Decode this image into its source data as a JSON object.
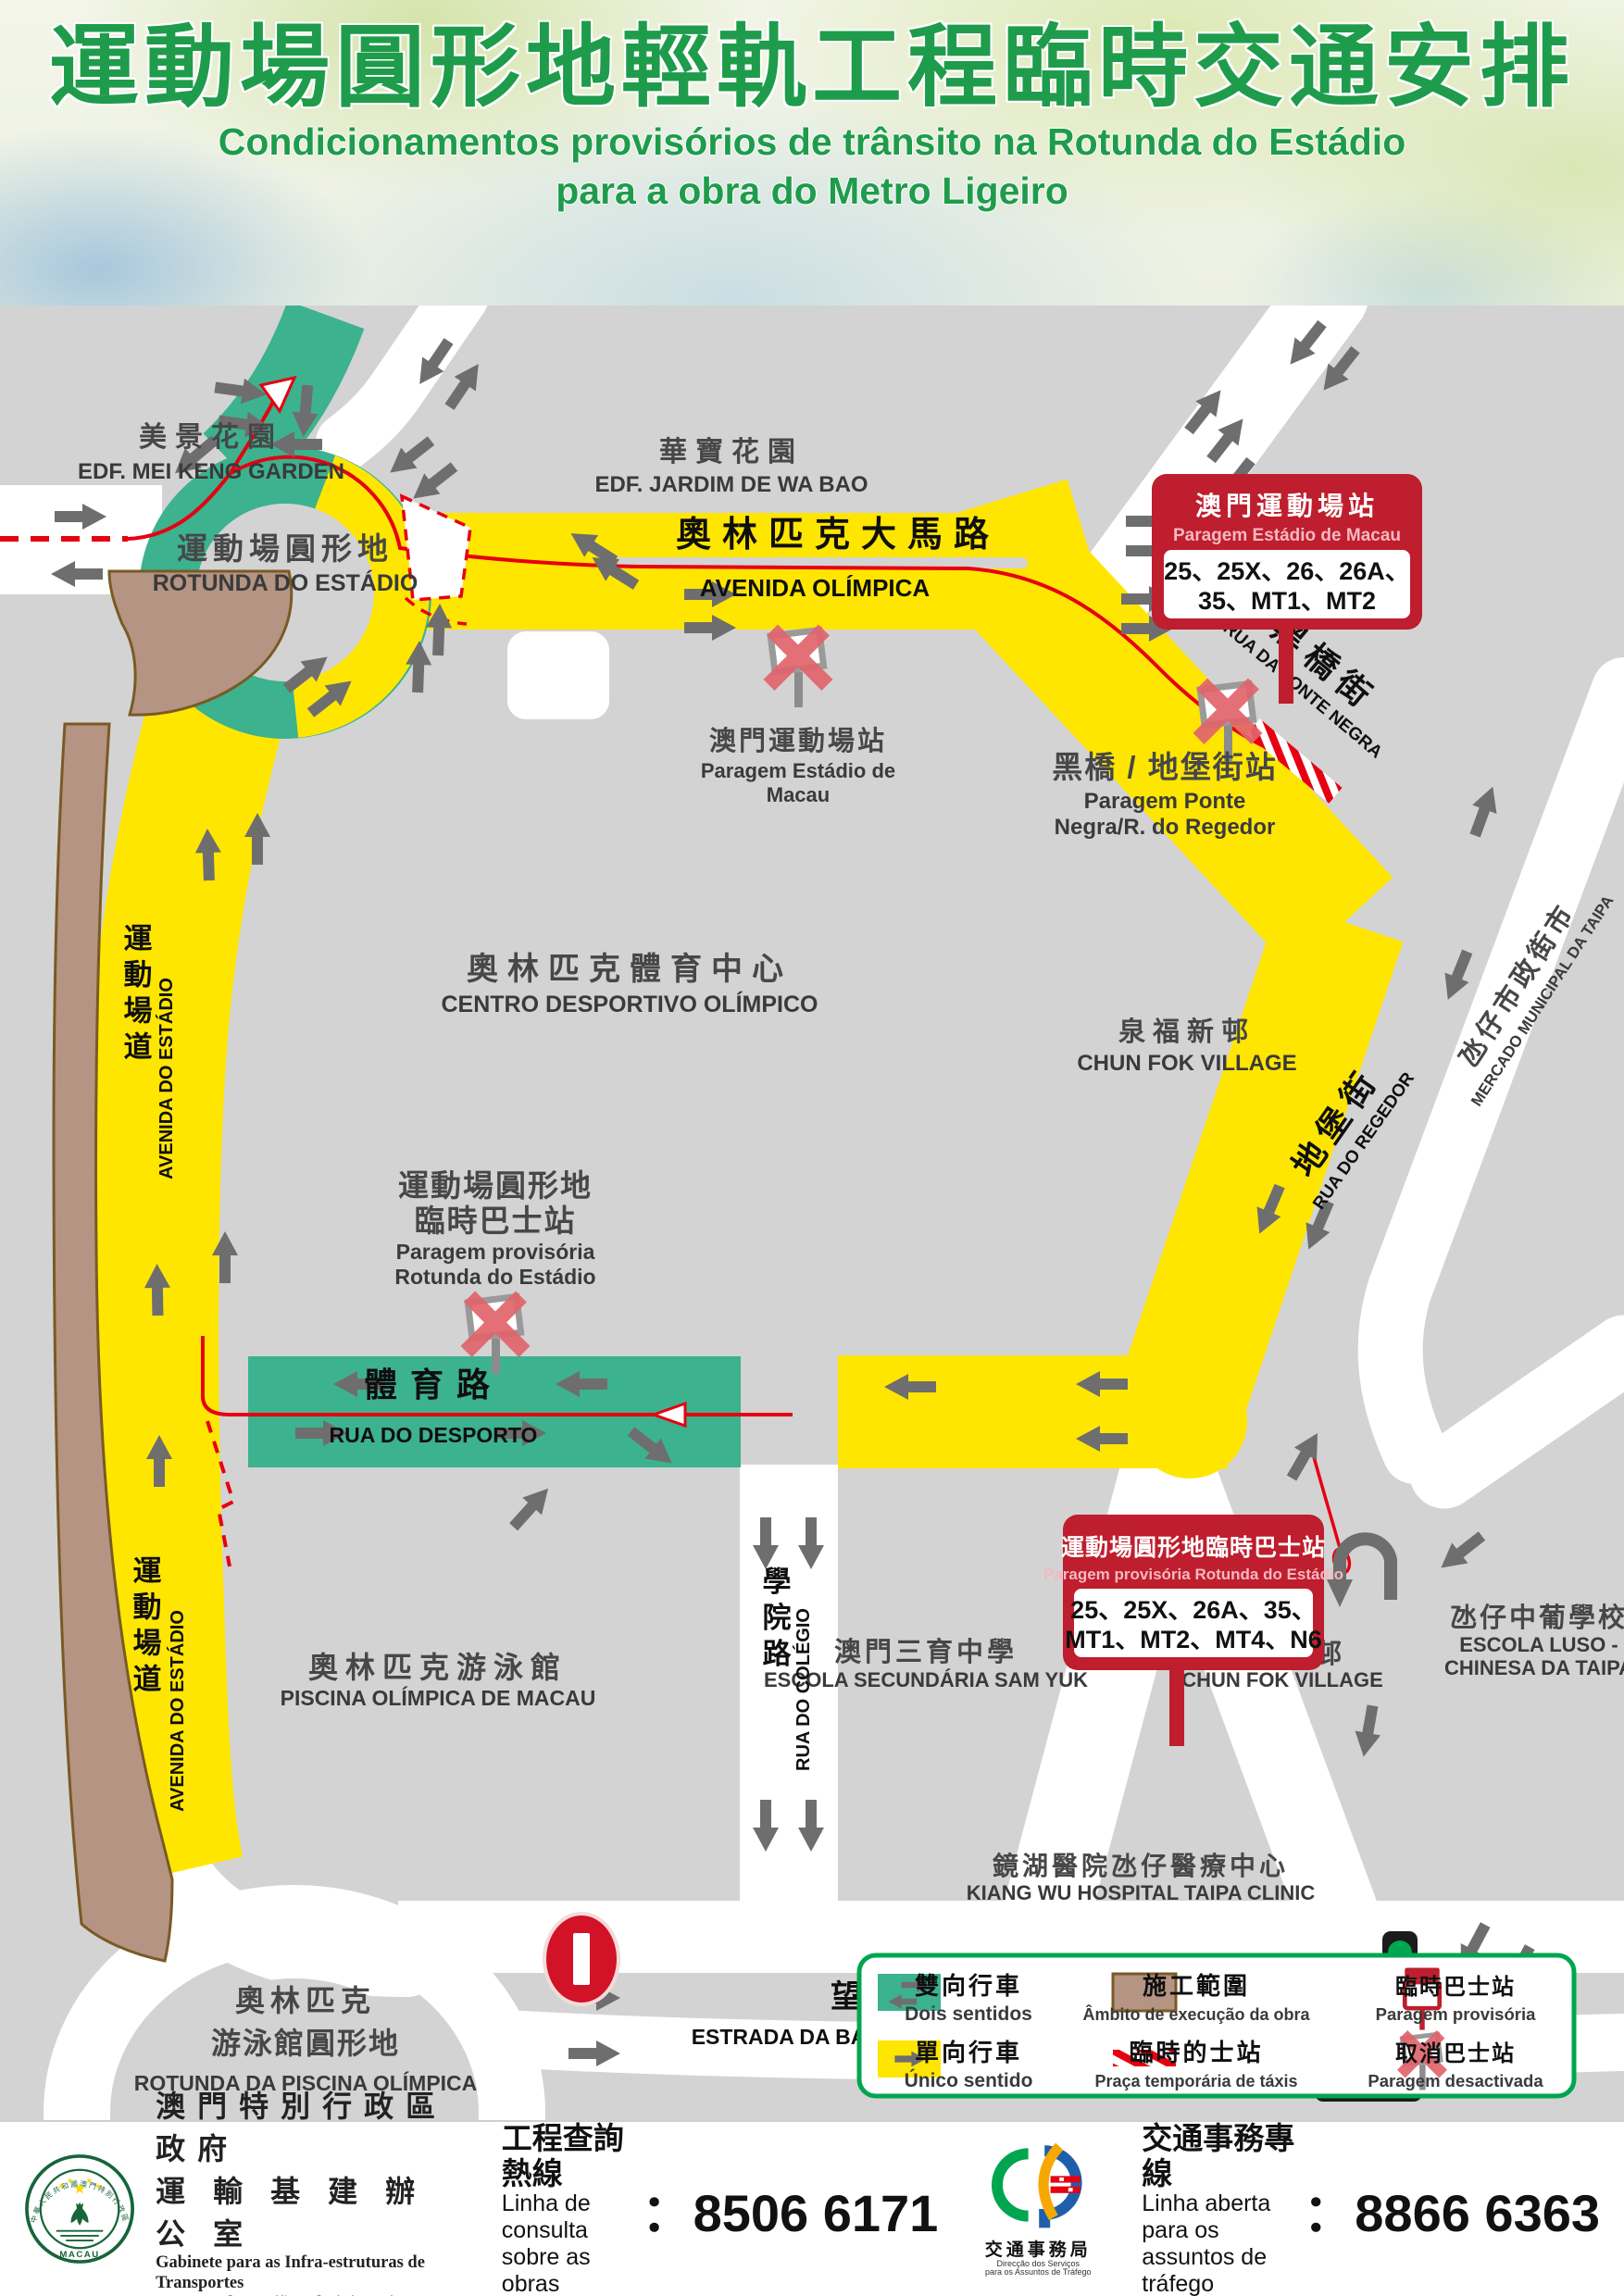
{
  "header": {
    "title": "運動場圓形地輕軌工程臨時交通安排",
    "subtitle1": "Condicionamentos provisórios de trânsito na Rotunda do Estádio",
    "subtitle2": "para a obra do Metro Ligeiro"
  },
  "map": {
    "places": {
      "mei_keng": {
        "zh": "美景花園",
        "en": "EDF. MEI KENG GARDEN"
      },
      "wa_bao": {
        "zh": "華寶花園",
        "en": "EDF. JARDIM DE WA BAO"
      },
      "rotunda_estadio": {
        "zh": "運動場圓形地",
        "pt": "ROTUNDA DO ESTÁDIO"
      },
      "centro_desportivo": {
        "zh": "奧林匹克體育中心",
        "pt": "CENTRO DESPORTIVO OLÍMPICO"
      },
      "chun_fok_north": {
        "zh": "泉福新邨",
        "en": "CHUN FOK VILLAGE"
      },
      "chun_fok_south": {
        "zh": "泉福新邨",
        "en": "CHUN FOK VILLAGE"
      },
      "sam_yuk": {
        "zh": "澳門三育中學",
        "pt": "ESCOLA SECUNDÁRIA SAM YUK"
      },
      "luso_chinesa": {
        "zh": "氹仔中葡學校",
        "pt1": "ESCOLA LUSO -",
        "pt2": "CHINESA DA TAIPA"
      },
      "piscina": {
        "zh": "奧林匹克游泳館",
        "pt": "PISCINA OLÍMPICA DE MACAU"
      },
      "kiang_wu": {
        "zh": "鏡湖醫院氹仔醫療中心",
        "en": "KIANG WU HOSPITAL TAIPA CLINIC"
      },
      "rotunda_piscina": {
        "zh1": "奧林匹克",
        "zh2": "游泳館圓形地",
        "pt": "ROTUNDA DA PISCINA OLÍMPICA"
      },
      "mercado": {
        "zh": "氹仔市政街市",
        "pt": "MERCADO MUNICIPAL DA TAIPA"
      }
    },
    "roads": {
      "av_olimpica": {
        "zh": "奧林匹克大馬路",
        "pt": "AVENIDA OLÍMPICA"
      },
      "ponte_negra": {
        "zh": "黑橋街",
        "pt": "RUA DA PONTE NEGRA"
      },
      "regedor": {
        "zh": "地堡街",
        "pt": "RUA DO REGEDOR"
      },
      "av_estadio": {
        "zh": "運動場道",
        "pt": "AVENIDA DO ESTÁDIO"
      },
      "desporto": {
        "zh": "體育路",
        "pt": "RUA DO DESPORTO"
      },
      "colegio": {
        "zh": "學院路",
        "pt": "RUA DO COLÉGIO"
      },
      "esperanca": {
        "zh": "望德聖母灣大馬路",
        "pt": "ESTRADA DA BAÍA DE NOSSA SENHORA DA ESPERANÇA"
      }
    },
    "stops": {
      "estadio": {
        "zh": "澳門運動場站",
        "pt1": "Paragem Estádio de",
        "pt2": "Macau"
      },
      "ponte_negra": {
        "zh": "黑橋 / 地堡街站",
        "pt1": "Paragem Ponte",
        "pt2": "Negra/R. do Regedor"
      },
      "rotunda_temp": {
        "zh1": "運動場圓形地",
        "zh2": "臨時巴士站",
        "pt1": "Paragem provisória",
        "pt2": "Rotunda do Estádio"
      }
    },
    "signs": {
      "estadio": {
        "zh": "澳門運動場站",
        "pt": "Paragem Estádio de Macau",
        "routes1": "25、25X、26、26A、",
        "routes2": "35、MT1、MT2"
      },
      "rotunda": {
        "zh": "運動場圓形地臨時巴士站",
        "pt": "Paragem provisória Rotunda do Estádio",
        "routes1": "25、25X、26A、35、",
        "routes2": "MT1、MT2、MT4、N6"
      }
    }
  },
  "legend": {
    "two_way": {
      "zh": "雙向行車",
      "pt": "Dois sentidos"
    },
    "one_way": {
      "zh": "單向行車",
      "pt": "Único sentido"
    },
    "construction": {
      "zh": "施工範圍",
      "pt": "Âmbito de execução da obra"
    },
    "taxi": {
      "zh": "臨時的士站",
      "pt": "Praça temporária de táxis"
    },
    "temp_stop": {
      "zh": "臨時巴士站",
      "pt": "Paragem provisória"
    },
    "cancelled_stop": {
      "zh": "取消巴士站",
      "pt": "Paragem desactivada"
    }
  },
  "footer": {
    "seal_ring": "中華人民共和國澳門特別行政區",
    "seal_macau": "MACAU",
    "gov_zh1": "澳門特別行政區政府",
    "gov_zh2": "運輸基建辦公室",
    "gov_pt1": "Gabinete para as Infra-estruturas de Transportes",
    "gov_pt2": "Governo da Região Administrativa Especial de Macau",
    "works_zh": "工程查詢熱線",
    "works_pt1": "Linha de consulta",
    "works_pt2": "sobre as obras",
    "colon": "：",
    "works_phone": "8506 6171",
    "dsat_zh": "交通事務局",
    "dsat_pt1": "Direcção dos Serviços",
    "dsat_pt2": "para os Assuntos de Tráfego",
    "traffic_zh": "交通事務專線",
    "traffic_pt1": "Linha aberta para os",
    "traffic_pt2": "assuntos de tráfego",
    "traffic_phone": "8866 6363"
  },
  "palette": {
    "one_way_yellow": "#FFE600",
    "two_way_teal": "#3CB28E",
    "construction_brown": "#B59483",
    "marking_red": "#E60012",
    "sign_red": "#BE1E2D",
    "title_green": "#1E9C4B",
    "legend_border_green": "#00A64F",
    "map_gray": "#D3D3D3",
    "arrow_gray": "#6E6E6E"
  }
}
